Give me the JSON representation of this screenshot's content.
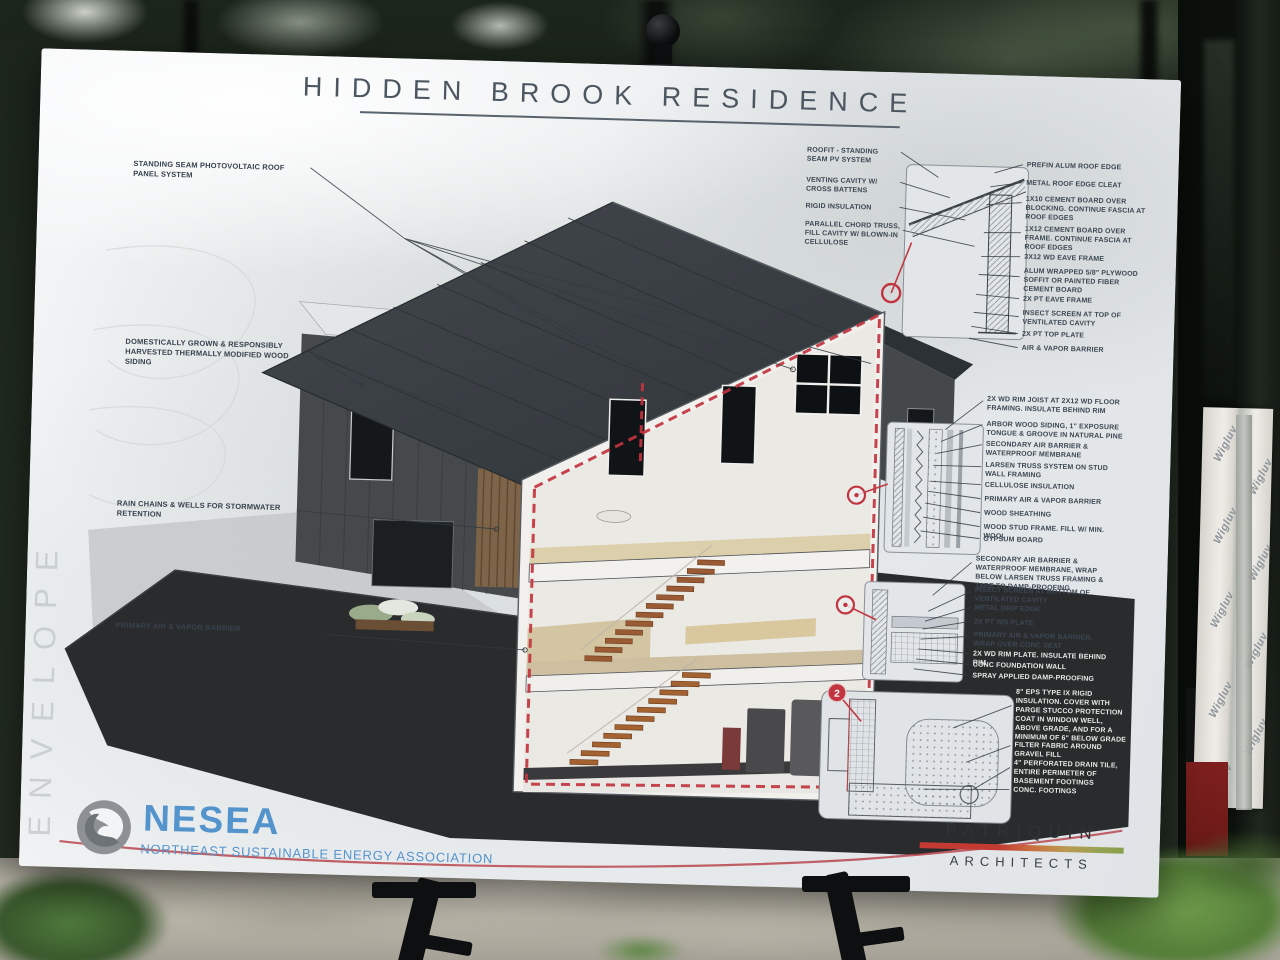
{
  "poster": {
    "title": "HIDDEN BROOK RESIDENCE",
    "envelope_label": "ENVELOPE",
    "detail_marker_label": "2",
    "callouts": {
      "left": [
        "STANDING SEAM PHOTOVOLTAIC ROOF PANEL SYSTEM",
        "DOMESTICALLY GROWN & RESPONSIBLY HARVESTED THERMALLY MODIFIED WOOD SIDING",
        "RAIN CHAINS & WELLS FOR STORMWATER RETENTION",
        "PRIMARY AIR & VAPOR BARRIER"
      ],
      "roof_left": [
        "ROOFIT - STANDING SEAM PV SYSTEM",
        "VENTING CAVITY W/ CROSS BATTENS",
        "RIGID INSULATION",
        "PARALLEL CHORD TRUSS, FILL CAVITY W/ BLOWN-IN CELLULOSE"
      ],
      "roof_right": [
        "PREFIN ALUM ROOF EDGE",
        "METAL ROOF EDGE CLEAT",
        "1X10 CEMENT BOARD OVER BLOCKING. CONTINUE FASCIA AT ROOF EDGES",
        "1X12 CEMENT BOARD OVER FRAME. CONTINUE FASCIA AT ROOF EDGES",
        "3x12 WD EAVE FRAME",
        "ALUM WRAPPED 5/8\" PLYWOOD SOFFIT OR PAINTED FIBER CEMENT BOARD",
        "2X PT EAVE FRAME",
        "INSECT SCREEN AT TOP OF VENTILATED CAVITY",
        "2X PT TOP PLATE",
        "AIR & VAPOR BARRIER"
      ],
      "wall": [
        "2X WD RIM JOIST AT 2X12 WD FLOOR FRAMING. INSULATE BEHIND RIM",
        "ARBOR WOOD SIDING, 1\" EXPOSURE TONGUE & GROOVE IN NATURAL PINE",
        "SECONDARY AIR BARRIER & WATERPROOF MEMBRANE",
        "LARSEN TRUSS SYSTEM ON STUD WALL FRAMING",
        "CELLULOSE INSULATION",
        "PRIMARY AIR & VAPOR BARRIER",
        "WOOD SHEATHING",
        "WOOD STUD FRAME. FILL W/ MIN. WOOL",
        "GYPSUM BOARD"
      ],
      "base": [
        "SECONDARY AIR BARRIER & WATERPROOF MEMBRANE, WRAP BELOW LARSEN TRUSS FRAMING & TAPE TO DAMP-PROOFING",
        "INSECT SCREEN AT BOTTOM OF VENTILATED CAVITY",
        "METAL DRIP EDGE",
        "2X PT WD PLATE",
        "PRIMARY AIR & VAPOR BARRIER, WRAP OVER CONC SEAT",
        "2X WD RIM PLATE. INSULATE BEHIND RIM",
        "CONC FOUNDATION WALL",
        "SPRAY APPLIED DAMP-PROOFING"
      ],
      "foundation": [
        "8\" EPS TYPE IX RIGID INSULATION. COVER WITH PARGE STUCCO PROTECTION COAT IN WINDOW WELL, ABOVE GRADE, AND FOR A MINIMUM OF 6\" BELOW GRADE",
        "FILTER FABRIC AROUND GRAVEL FILL",
        "4\" PERFORATED DRAIN TILE, ENTIRE PERIMETER OF BASEMENT FOOTINGS",
        "CONC. FOOTINGS"
      ]
    },
    "logos": {
      "nesea": {
        "name": "NESEA",
        "tagline": "NORTHEAST SUSTAINABLE ENERGY ASSOCIATION"
      },
      "patriquin": {
        "line1": "PATRIQUIN",
        "line2": "ARCHITECTS"
      }
    }
  },
  "background": {
    "tape_text": "Wigluv"
  },
  "colors": {
    "envelope_red": "#c2343f",
    "title_gray": "#4c5660",
    "nesea_blue": "#5494cc",
    "patriquin_bar_left": "#c23a32",
    "patriquin_bar_right": "#86a04c",
    "ground_charcoal": "#2a2b2d"
  }
}
